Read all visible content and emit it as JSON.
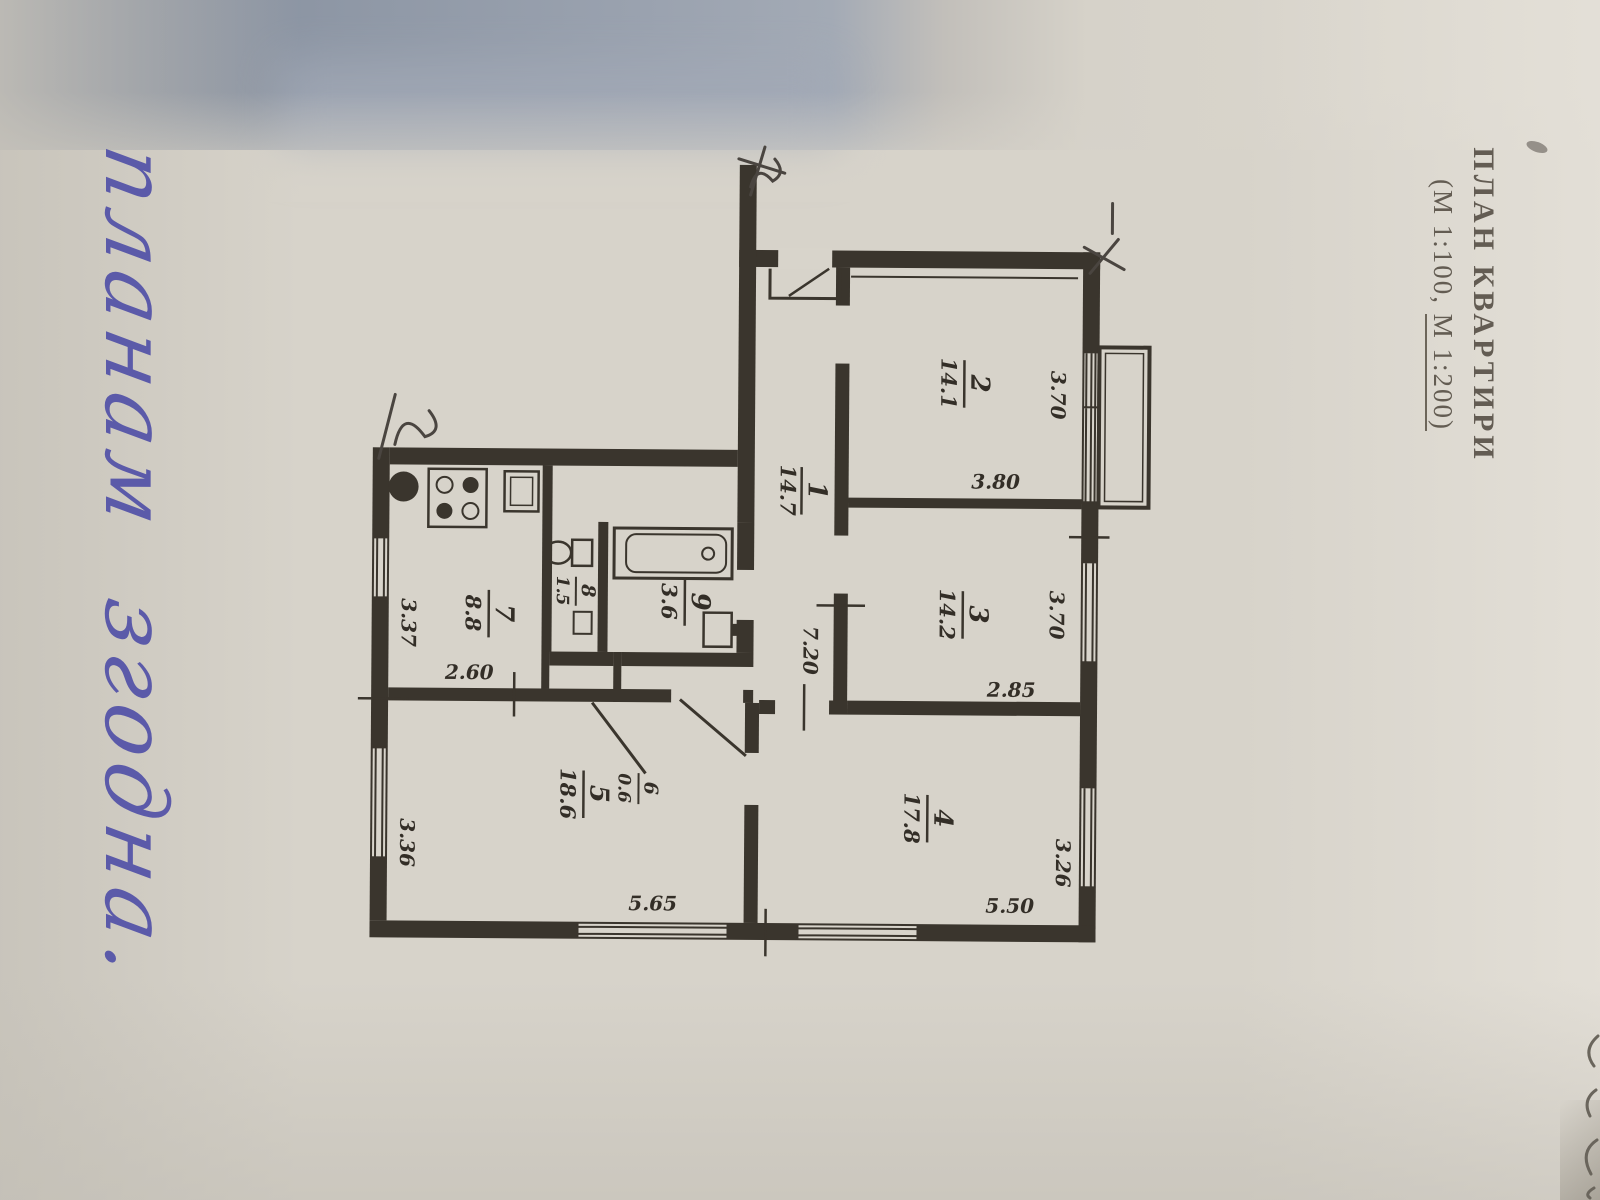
{
  "doc": {
    "title_line1": "ПЛАН КВАРТИРИ",
    "title_line2_part1": "(М 1:100,",
    "title_line2_part2": "М 1:200)",
    "handwriting_word1": "планам",
    "handwriting_word2": "згодна."
  },
  "plan": {
    "rooms": [
      {
        "num": "1",
        "area": "14.7"
      },
      {
        "num": "2",
        "area": "14.1"
      },
      {
        "num": "3",
        "area": "14.2"
      },
      {
        "num": "4",
        "area": "17.8"
      },
      {
        "num": "5",
        "area": "18.6"
      },
      {
        "num": "6",
        "area": "0.6"
      },
      {
        "num": "7",
        "area": "8.8"
      },
      {
        "num": "8",
        "area": "1.5"
      },
      {
        "num": "9",
        "area": "3.6"
      }
    ],
    "dims": {
      "room2_w": "3.70",
      "room2_h": "3.80",
      "room3_w": "3.70",
      "room3_h": "2.85",
      "room4_w": "3.26",
      "room4_h": "5.50",
      "hall_len": "7.20",
      "room5_w": "3.36",
      "room5_h": "5.65",
      "kitchen_w": "3.37",
      "kitchen_h": "2.60"
    }
  },
  "colors": {
    "ink": "#3a352d",
    "paper": "#d7d3ca",
    "pen_blue": "#4c4ba6",
    "shadow_band": "#98a1ae"
  }
}
